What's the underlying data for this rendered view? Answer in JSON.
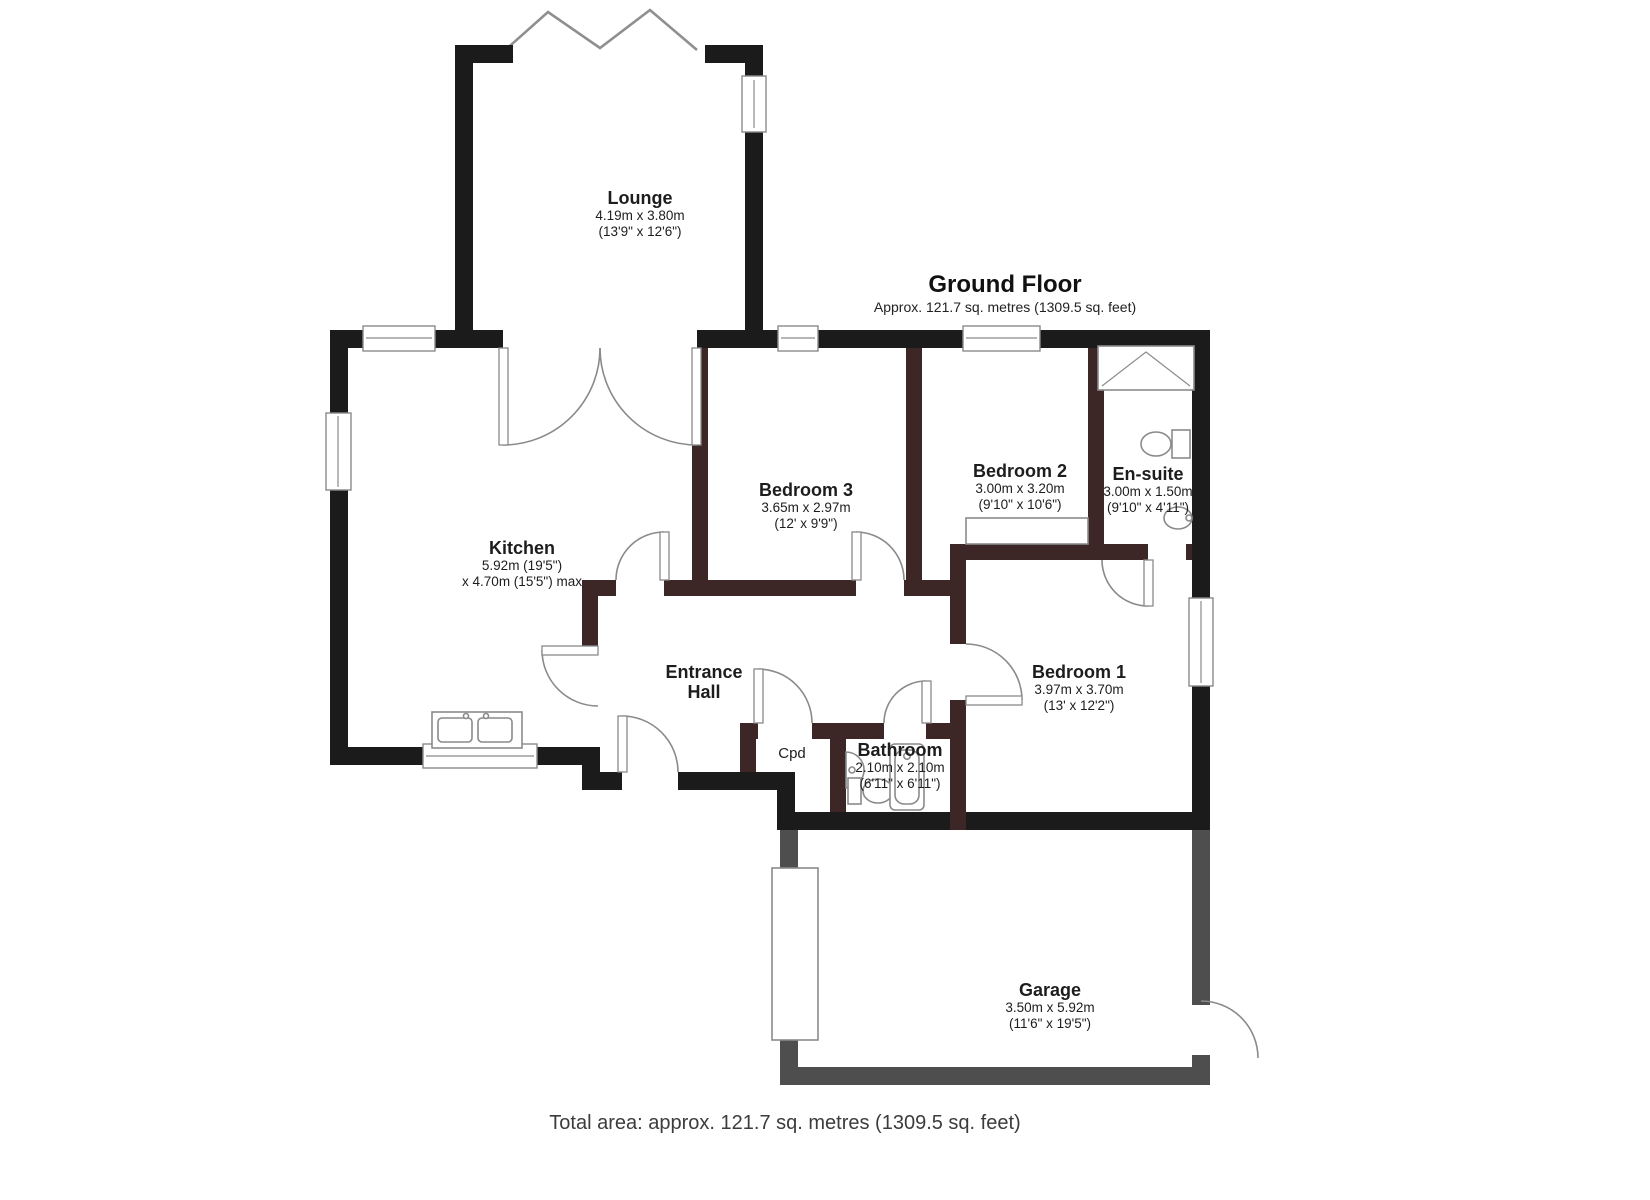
{
  "title": {
    "heading": "Ground Floor",
    "subheading": "Approx. 121.7 sq. metres (1309.5 sq. feet)"
  },
  "footer": {
    "total_area": "Total area: approx. 121.7 sq. metres (1309.5 sq. feet)"
  },
  "rooms": {
    "lounge": {
      "name": "Lounge",
      "metric": "4.19m x 3.80m",
      "imperial": "(13'9\" x 12'6\")"
    },
    "kitchen": {
      "name": "Kitchen",
      "metric": "5.92m (19'5\")",
      "imperial": "x 4.70m (15'5\") max"
    },
    "bedroom3": {
      "name": "Bedroom 3",
      "metric": "3.65m x 2.97m",
      "imperial": "(12' x 9'9\")"
    },
    "bedroom2": {
      "name": "Bedroom 2",
      "metric": "3.00m x 3.20m",
      "imperial": "(9'10\" x 10'6\")"
    },
    "ensuite": {
      "name": "En-suite",
      "metric": "3.00m x 1.50m",
      "imperial": "(9'10\" x 4'11\")"
    },
    "hall": {
      "line1": "Entrance",
      "line2": "Hall"
    },
    "cupboard": {
      "name": "Cpd"
    },
    "bathroom": {
      "name": "Bathroom",
      "metric": "2.10m x 2.10m",
      "imperial": "(6'11\" x 6'11\")"
    },
    "bedroom1": {
      "name": "Bedroom 1",
      "metric": "3.97m x 3.70m",
      "imperial": "(13' x 12'2\")"
    },
    "garage": {
      "name": "Garage",
      "metric": "3.50m x 5.92m",
      "imperial": "(11'6\" x 19'5\")"
    }
  },
  "colors": {
    "exterior_wall": "#1b1b1b",
    "interior_wall": "#3c2626",
    "garage_wall": "#4e4e4e",
    "fixture_line": "#8a8a8a",
    "text": "#1d1d1d"
  }
}
